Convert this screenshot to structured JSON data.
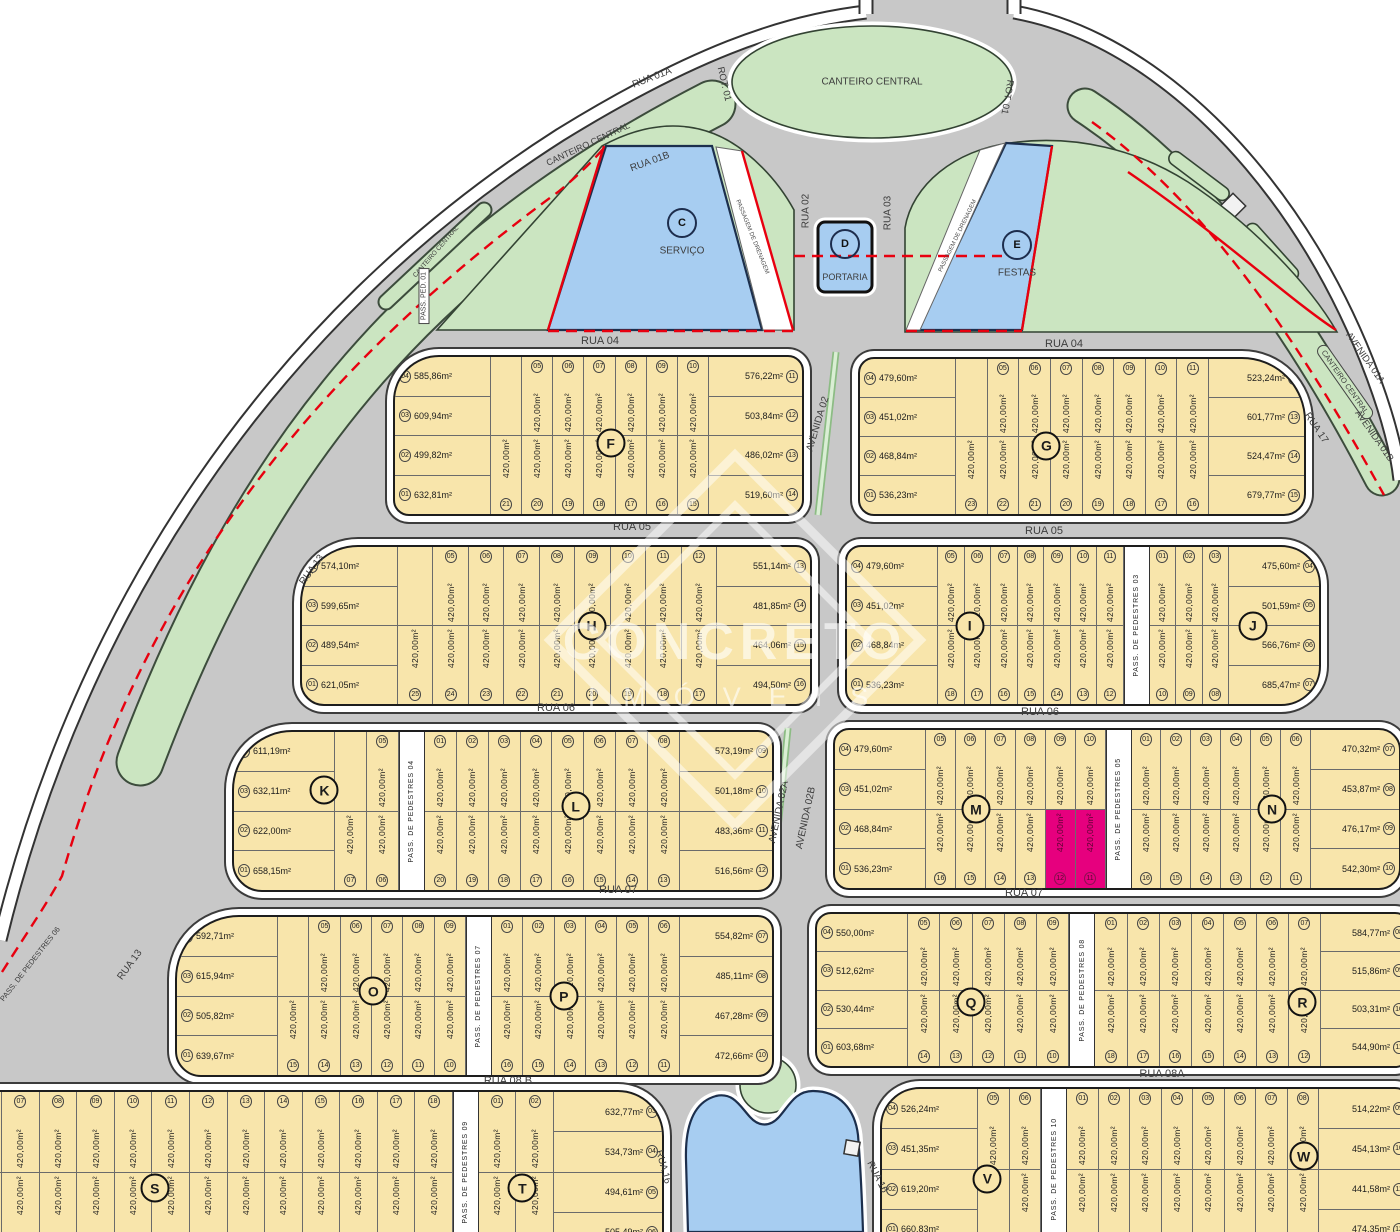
{
  "watermark": {
    "brand": "CONCRETO",
    "sub": "IMÓVEIS"
  },
  "palette": {
    "road": "#c8c8c8",
    "green": "#cbe5c1",
    "water": "#a7cdf1",
    "lot_yellow": "#f8e5ab",
    "highlight": "#e6007e",
    "red_line": "#e8000f",
    "white_band": "#ffffff",
    "label": "#3d3d3d"
  },
  "lot_default_area": "420,00m²",
  "road_labels": [
    {
      "t": "RUA 04",
      "x": 600,
      "y": 341
    },
    {
      "t": "RUA 04",
      "x": 1064,
      "y": 344
    },
    {
      "t": "RUA 05",
      "x": 632,
      "y": 527
    },
    {
      "t": "RUA 05",
      "x": 1044,
      "y": 531
    },
    {
      "t": "RUA 06",
      "x": 556,
      "y": 708
    },
    {
      "t": "RUA 06",
      "x": 1040,
      "y": 712
    },
    {
      "t": "RUA 07",
      "x": 618,
      "y": 890
    },
    {
      "t": "RUA 07",
      "x": 1024,
      "y": 893
    },
    {
      "t": "RUA 08 B",
      "x": 508,
      "y": 1081
    },
    {
      "t": "RUA 08A",
      "x": 1162,
      "y": 1074
    },
    {
      "t": "RUA 01A",
      "x": 652,
      "y": 78,
      "r": -21,
      "fs": 10
    },
    {
      "t": "CANTEIRO CENTRAL",
      "x": 588,
      "y": 144,
      "r": -25,
      "fs": 9
    },
    {
      "t": "RUA 01B",
      "x": 650,
      "y": 162,
      "r": -20,
      "fs": 10
    },
    {
      "t": "CANTEIRO CENTRAL",
      "x": 436,
      "y": 252,
      "r": -49,
      "fs": 6.5
    },
    {
      "t": "PASS. PED. 01",
      "x": 424,
      "y": 296,
      "r": -90,
      "fs": 7,
      "cls": "boxw"
    },
    {
      "t": "ROT. 01",
      "x": 724,
      "y": 84,
      "r": 77,
      "fs": 9.5
    },
    {
      "t": "CANTEIRO CENTRAL",
      "x": 872,
      "y": 82,
      "fs": 10
    },
    {
      "t": "ROT. 01",
      "x": 1007,
      "y": 97,
      "r": 100,
      "fs": 9.5
    },
    {
      "t": "RUA 02",
      "x": 806,
      "y": 211,
      "r": -90,
      "fs": 10
    },
    {
      "t": "RUA 03",
      "x": 888,
      "y": 213,
      "r": -90,
      "fs": 10
    },
    {
      "t": "AVENIDA 02",
      "x": 818,
      "y": 424,
      "r": -73,
      "fs": 10
    },
    {
      "t": "AVENIDA 02A",
      "x": 779,
      "y": 812,
      "r": -78,
      "fs": 10
    },
    {
      "t": "AVENIDA 02B",
      "x": 806,
      "y": 818,
      "r": -78,
      "fs": 10
    },
    {
      "t": "RUA 13",
      "x": 312,
      "y": 570,
      "r": -54,
      "fs": 10
    },
    {
      "t": "RUA 13",
      "x": 130,
      "y": 965,
      "r": -54,
      "fs": 10
    },
    {
      "t": "RUA 17",
      "x": 1316,
      "y": 428,
      "r": 56,
      "fs": 10
    },
    {
      "t": "AVENIDA 01A",
      "x": 1365,
      "y": 358,
      "r": 55,
      "fs": 9.5
    },
    {
      "t": "CANTEIRO CENTRAL",
      "x": 1345,
      "y": 382,
      "r": 55,
      "fs": 7.5,
      "cls": "boxg"
    },
    {
      "t": "AVENIDA 01B",
      "x": 1374,
      "y": 436,
      "r": 55,
      "fs": 9.5
    },
    {
      "t": "RUA 16",
      "x": 663,
      "y": 1167,
      "r": 75,
      "fs": 10
    },
    {
      "t": "RUA 16",
      "x": 877,
      "y": 1177,
      "r": 63,
      "fs": 10
    },
    {
      "t": "PASS. DE PEDESTRES 06",
      "x": 30,
      "y": 964,
      "r": -52,
      "fs": 7.5
    },
    {
      "t": "C",
      "x": 682,
      "y": 223,
      "cls": "mletter"
    },
    {
      "t": "SERVIÇO",
      "x": 682,
      "y": 251,
      "fs": 10
    },
    {
      "t": "D",
      "x": 845,
      "y": 244,
      "cls": "mletter"
    },
    {
      "t": "PORTARIA",
      "x": 845,
      "y": 277,
      "fs": 9
    },
    {
      "t": "E",
      "x": 1017,
      "y": 245,
      "cls": "mletter"
    },
    {
      "t": "FESTAS",
      "x": 1017,
      "y": 273,
      "fs": 10
    },
    {
      "t": "PASSAGEM DE DRENAGEM",
      "x": 752,
      "y": 237,
      "r": 68,
      "fs": 6,
      "cls": "drain"
    },
    {
      "t": "PASSAGEM DE DRENAGEM",
      "x": 958,
      "y": 236,
      "r": -64,
      "fs": 6,
      "cls": "drain"
    }
  ],
  "blocks": [
    {
      "id": "F",
      "x": 393,
      "y": 355,
      "w": 407,
      "h": 157,
      "r": [
        46,
        16,
        16,
        16
      ],
      "letters": [
        [
          "F",
          0.53,
          0.55
        ]
      ],
      "left": {
        "w": 95,
        "cells": [
          [
            "04",
            "585,86m²"
          ],
          [
            "03",
            "609,94m²"
          ],
          [
            "02",
            "499,82m²"
          ],
          [
            "01",
            "632,81m²"
          ]
        ]
      },
      "strips": [
        [
          null,
          "21"
        ],
        [
          "05",
          "20"
        ],
        [
          "06",
          "19"
        ],
        [
          "07",
          "18"
        ],
        [
          "08",
          "17"
        ],
        [
          "09",
          "16"
        ],
        [
          "10",
          "15"
        ]
      ],
      "right": {
        "w": 93,
        "cells": [
          [
            "11",
            "576,22m²"
          ],
          [
            "12",
            "503,84m²"
          ],
          [
            "13",
            "486,02m²"
          ],
          [
            "14",
            "519,60m²"
          ]
        ]
      }
    },
    {
      "id": "G",
      "x": 858,
      "y": 357,
      "w": 444,
      "h": 155,
      "r": [
        16,
        64,
        22,
        16
      ],
      "letters": [
        [
          "G",
          0.42,
          0.56
        ]
      ],
      "left": {
        "w": 95,
        "cells": [
          [
            "04",
            "479,60m²"
          ],
          [
            "03",
            "451,02m²"
          ],
          [
            "02",
            "468,84m²"
          ],
          [
            "01",
            "536,23m²"
          ]
        ]
      },
      "strips": [
        [
          null,
          "23"
        ],
        [
          "05",
          "22"
        ],
        [
          "06",
          "21"
        ],
        [
          "07",
          "20"
        ],
        [
          "08",
          "19"
        ],
        [
          "09",
          "18"
        ],
        [
          "10",
          "17"
        ],
        [
          "11",
          "16"
        ]
      ],
      "right": {
        "w": 95,
        "cells": [
          [
            "12",
            "523,24m²"
          ],
          [
            "13",
            "601,77m²"
          ],
          [
            "14",
            "524,47m²"
          ],
          [
            "15",
            "679,77m²"
          ]
        ]
      }
    },
    {
      "id": "H",
      "x": 300,
      "y": 545,
      "w": 508,
      "h": 157,
      "r": [
        58,
        16,
        16,
        24
      ],
      "letters": [
        [
          "H",
          0.57,
          0.5
        ]
      ],
      "left": {
        "w": 95,
        "cells": [
          [
            "04",
            "574,10m²"
          ],
          [
            "03",
            "599,65m²"
          ],
          [
            "02",
            "489,54m²"
          ],
          [
            "01",
            "621,05m²"
          ]
        ]
      },
      "strips": [
        [
          null,
          "25"
        ],
        [
          "05",
          "24"
        ],
        [
          "06",
          "23"
        ],
        [
          "07",
          "22"
        ],
        [
          "08",
          "21"
        ],
        [
          "09",
          "20"
        ],
        [
          "10",
          "19"
        ],
        [
          "11",
          "18"
        ],
        [
          "12",
          "17"
        ]
      ],
      "right": {
        "w": 93,
        "cells": [
          [
            "13",
            "551,14m²"
          ],
          [
            "14",
            "481,85m²"
          ],
          [
            "15",
            "464,06m²"
          ],
          [
            "16",
            "494,50m²"
          ]
        ]
      }
    },
    {
      "id": "IJ",
      "x": 845,
      "y": 545,
      "w": 472,
      "h": 157,
      "r": [
        16,
        40,
        40,
        16
      ],
      "letters": [
        [
          "I",
          0.26,
          0.5
        ],
        [
          "J",
          0.86,
          0.5
        ]
      ],
      "left": {
        "w": 90,
        "cells": [
          [
            "04",
            "479,60m²"
          ],
          [
            "03",
            "451,02m²"
          ],
          [
            "02",
            "468,84m²"
          ],
          [
            "01",
            "536,23m²"
          ]
        ]
      },
      "strips": [
        [
          "05",
          "18"
        ],
        [
          "06",
          "17"
        ],
        [
          "07",
          "16"
        ],
        [
          "08",
          "15"
        ],
        [
          "09",
          "14"
        ],
        [
          "10",
          "13"
        ],
        [
          "11",
          "12"
        ],
        {
          "ped": "PASS. DE PEDESTRES 03"
        },
        [
          "01",
          "10"
        ],
        [
          "02",
          "09"
        ],
        [
          "03",
          "08"
        ]
      ],
      "right": {
        "w": 90,
        "cells": [
          [
            "04",
            "475,60m²"
          ],
          [
            "05",
            "501,59m²"
          ],
          [
            "06",
            "566,76m²"
          ],
          [
            "07",
            "685,47m²"
          ]
        ]
      }
    },
    {
      "id": "KL",
      "x": 232,
      "y": 730,
      "w": 538,
      "h": 158,
      "r": [
        60,
        16,
        16,
        30
      ],
      "letters": [
        [
          "K",
          0.168,
          0.37
        ],
        [
          "L",
          0.635,
          0.47
        ]
      ],
      "left": {
        "w": 100,
        "cells": [
          [
            "04",
            "611,19m²"
          ],
          [
            "03",
            "632,11m²"
          ],
          [
            "02",
            "622,00m²"
          ],
          [
            "01",
            "658,15m²"
          ]
        ]
      },
      "strips": [
        [
          null,
          "07"
        ],
        [
          "05",
          "06"
        ],
        {
          "ped": "PASS. DE PEDESTRES 04"
        },
        [
          "01",
          "20"
        ],
        [
          "02",
          "19"
        ],
        [
          "03",
          "18"
        ],
        [
          "04",
          "17"
        ],
        [
          "05",
          "16"
        ],
        [
          "06",
          "15"
        ],
        [
          "07",
          "14"
        ],
        [
          "08",
          "13"
        ]
      ],
      "right": {
        "w": 92,
        "cells": [
          [
            "09",
            "573,19m²"
          ],
          [
            "10",
            "501,18m²"
          ],
          [
            "11",
            "483,36m²"
          ],
          [
            "12",
            "516,56m²"
          ]
        ]
      }
    },
    {
      "id": "MN",
      "x": 833,
      "y": 728,
      "w": 564,
      "h": 158,
      "r": [
        16,
        22,
        22,
        16
      ],
      "letters": [
        [
          "M",
          0.25,
          0.5
        ],
        [
          "N",
          0.775,
          0.5
        ]
      ],
      "left": {
        "w": 90,
        "cells": [
          [
            "04",
            "479,60m²"
          ],
          [
            "03",
            "451,02m²"
          ],
          [
            "02",
            "468,84m²"
          ],
          [
            "01",
            "536,23m²"
          ]
        ]
      },
      "strips": [
        [
          "05",
          "16"
        ],
        [
          "06",
          "15"
        ],
        [
          "07",
          "14"
        ],
        [
          "08",
          "13"
        ],
        {
          "t": "09",
          "b": "12",
          "hb": true
        },
        {
          "t": "10",
          "b": "11",
          "hb": true
        },
        {
          "ped": "PASS. DE PEDESTRES 05"
        },
        [
          "01",
          "16"
        ],
        [
          "02",
          "15"
        ],
        [
          "03",
          "14"
        ],
        [
          "04",
          "13"
        ],
        [
          "05",
          "12"
        ],
        [
          "06",
          "11"
        ]
      ],
      "right": {
        "w": 88,
        "cells": [
          [
            "07",
            "470,32m²"
          ],
          [
            "08",
            "453,87m²"
          ],
          [
            "09",
            "476,17m²"
          ],
          [
            "10",
            "542,30m²"
          ]
        ]
      }
    },
    {
      "id": "OP",
      "x": 175,
      "y": 915,
      "w": 595,
      "h": 158,
      "r": [
        64,
        16,
        16,
        26
      ],
      "letters": [
        [
          "O",
          0.33,
          0.47
        ],
        [
          "P",
          0.65,
          0.5
        ]
      ],
      "left": {
        "w": 100,
        "cells": [
          [
            "04",
            "592,71m²"
          ],
          [
            "03",
            "615,94m²"
          ],
          [
            "02",
            "505,82m²"
          ],
          [
            "01",
            "639,67m²"
          ]
        ]
      },
      "strips": [
        [
          null,
          "15"
        ],
        [
          "05",
          "14"
        ],
        [
          "06",
          "13"
        ],
        [
          "07",
          "12"
        ],
        [
          "08",
          "11"
        ],
        [
          "09",
          "10"
        ],
        {
          "ped": "PASS. DE PEDESTRES 07"
        },
        [
          "01",
          "16"
        ],
        [
          "02",
          "15"
        ],
        [
          "03",
          "14"
        ],
        [
          "04",
          "13"
        ],
        [
          "05",
          "12"
        ],
        [
          "06",
          "11"
        ]
      ],
      "right": {
        "w": 92,
        "cells": [
          [
            "07",
            "554,82m²"
          ],
          [
            "08",
            "485,11m²"
          ],
          [
            "09",
            "467,28m²"
          ],
          [
            "10",
            "472,66m²"
          ]
        ]
      }
    },
    {
      "id": "QR",
      "x": 815,
      "y": 912,
      "w": 592,
      "h": 152,
      "r": [
        16,
        16,
        16,
        16
      ],
      "letters": [
        [
          "Q",
          0.26,
          0.58
        ],
        [
          "R",
          0.82,
          0.58
        ]
      ],
      "left": {
        "w": 90,
        "cells": [
          [
            "04",
            "550,00m²"
          ],
          [
            "03",
            "512,62m²"
          ],
          [
            "02",
            "530,44m²"
          ],
          [
            "01",
            "603,68m²"
          ]
        ]
      },
      "strips": [
        [
          "05",
          "14"
        ],
        [
          "06",
          "13"
        ],
        [
          "07",
          "12"
        ],
        [
          "08",
          "11"
        ],
        [
          "09",
          "10"
        ],
        {
          "ped": "PASS. DE PEDESTRES 08"
        },
        [
          "01",
          "18"
        ],
        [
          "02",
          "17"
        ],
        [
          "03",
          "16"
        ],
        [
          "04",
          "15"
        ],
        [
          "05",
          "14"
        ],
        [
          "06",
          "13"
        ],
        [
          "07",
          "12"
        ]
      ],
      "right": {
        "w": 88,
        "cells": [
          [
            "08",
            "584,77m²"
          ],
          [
            "09",
            "515,86m²"
          ],
          [
            "10",
            "503,31m²"
          ],
          [
            "11",
            "544,90m²"
          ]
        ]
      }
    },
    {
      "id": "ST",
      "x": -75,
      "y": 1090,
      "w": 735,
      "h": 160,
      "r": [
        4,
        46,
        20,
        4
      ],
      "letters": [
        [
          "S",
          0.31,
          0.6
        ],
        [
          "T",
          0.81,
          0.6
        ]
      ],
      "strips": [
        [
          "05",
          "32"
        ],
        [
          "06",
          "31"
        ],
        [
          "07",
          "30"
        ],
        [
          "08",
          "29"
        ],
        [
          "09",
          "28"
        ],
        [
          "10",
          "27"
        ],
        [
          "11",
          "26"
        ],
        [
          "12",
          "25"
        ],
        [
          "13",
          "24"
        ],
        [
          "14",
          "23"
        ],
        [
          "15",
          "22"
        ],
        [
          "16",
          "21"
        ],
        [
          "17",
          "20"
        ],
        [
          "18",
          "19"
        ],
        {
          "ped": "PASS. DE PEDESTRES 09"
        },
        [
          "01",
          "08"
        ],
        [
          "02",
          "07"
        ]
      ],
      "right": {
        "w": 108,
        "cells": [
          [
            "03",
            "632,77m²"
          ],
          [
            "04",
            "534,73m²"
          ],
          [
            "05",
            "494,61m²"
          ],
          [
            "06",
            "505,49m²"
          ]
        ]
      }
    },
    {
      "id": "VW",
      "x": 880,
      "y": 1087,
      "w": 527,
      "h": 160,
      "r": [
        40,
        16,
        16,
        16
      ],
      "letters": [
        [
          "V",
          0.2,
          0.56
        ],
        [
          "W",
          0.8,
          0.42
        ]
      ],
      "left": {
        "w": 95,
        "cells": [
          [
            "04",
            "526,24m²"
          ],
          [
            "03",
            "451,35m²"
          ],
          [
            "02",
            "619,20m²"
          ],
          [
            "01",
            "660,83m²"
          ]
        ]
      },
      "strips": [
        [
          "05",
          null
        ],
        [
          "06",
          "07"
        ],
        {
          "ped": "PASS. DE PEDESTRES 10"
        },
        [
          "01",
          "20"
        ],
        [
          "02",
          "19"
        ],
        [
          "03",
          "18"
        ],
        [
          "04",
          "17"
        ],
        [
          "05",
          "16"
        ],
        [
          "06",
          "15"
        ],
        [
          "07",
          "14"
        ],
        [
          "08",
          "13"
        ]
      ],
      "right": {
        "w": 90,
        "cells": [
          [
            "09",
            "514,22m²"
          ],
          [
            "10",
            "454,13m²"
          ],
          [
            "11",
            "441,58m²"
          ],
          [
            "12",
            "474,35m²"
          ]
        ]
      }
    }
  ]
}
